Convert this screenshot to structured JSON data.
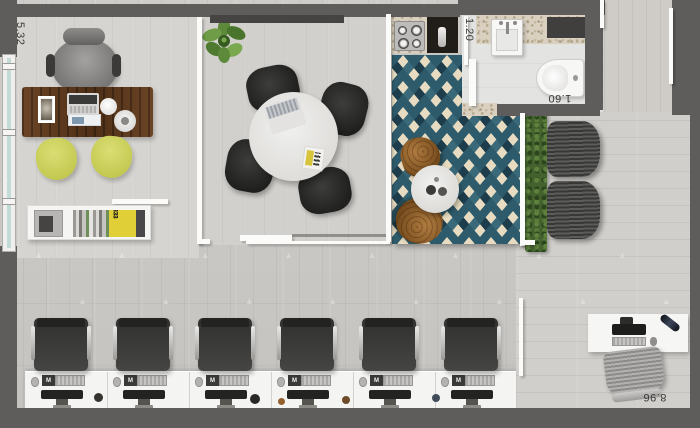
{
  "plan": {
    "title": "Office floor plan",
    "dimensions": {
      "left_wall": "5.32",
      "bath_door": "1.20",
      "bath_width": "1.60",
      "bottom_wall": "8.96"
    },
    "workstations": {
      "count": 6,
      "keyboard_badge": "M"
    },
    "reception": {
      "book_spine": "333"
    },
    "colors": {
      "wall": "#5e5d5b",
      "floor": "#c9c7c3",
      "rug_teal": "#2e5b6b",
      "rug_cream": "#e7dcc1",
      "rug_navy": "#1e3d4c",
      "chair_yellow": "#ccd25e",
      "desk_wood": "#5f3c20",
      "hedge_green": "#44622e"
    }
  }
}
